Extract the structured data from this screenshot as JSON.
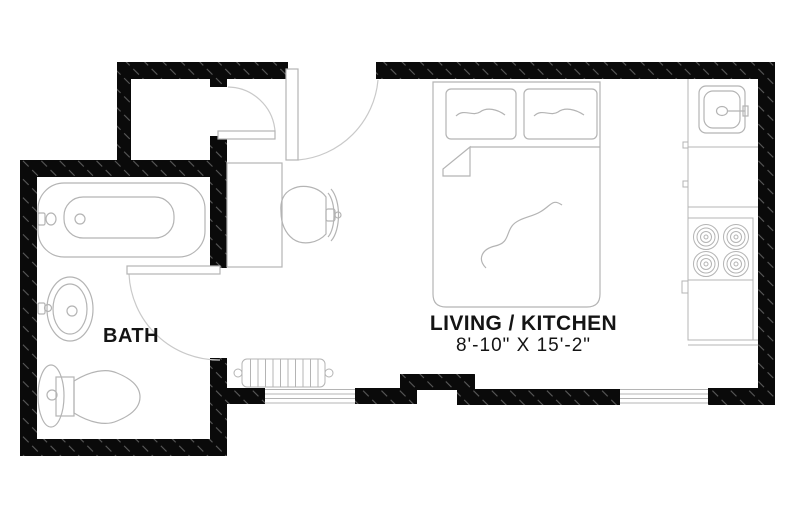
{
  "rooms": {
    "bath": {
      "label": "BATH"
    },
    "living_kitchen": {
      "label": "LIVING / KITCHEN",
      "dimensions": "8'-10\" X 15'-2\""
    }
  },
  "colors": {
    "background": "#ffffff",
    "wall": "#0a0a0a",
    "wall_hatch": "#5a5a5a",
    "fixture_line": "#b4b4b4",
    "door_line": "#c9c9c9",
    "text": "#141414"
  },
  "fixtures": [
    "bathtub",
    "bathroom-sink",
    "toilet",
    "bath-door",
    "closet-door",
    "entry-door",
    "radiator",
    "window-left",
    "window-right",
    "bed",
    "pillows",
    "table",
    "chair",
    "kitchen-counter",
    "kitchen-sink",
    "stove"
  ]
}
